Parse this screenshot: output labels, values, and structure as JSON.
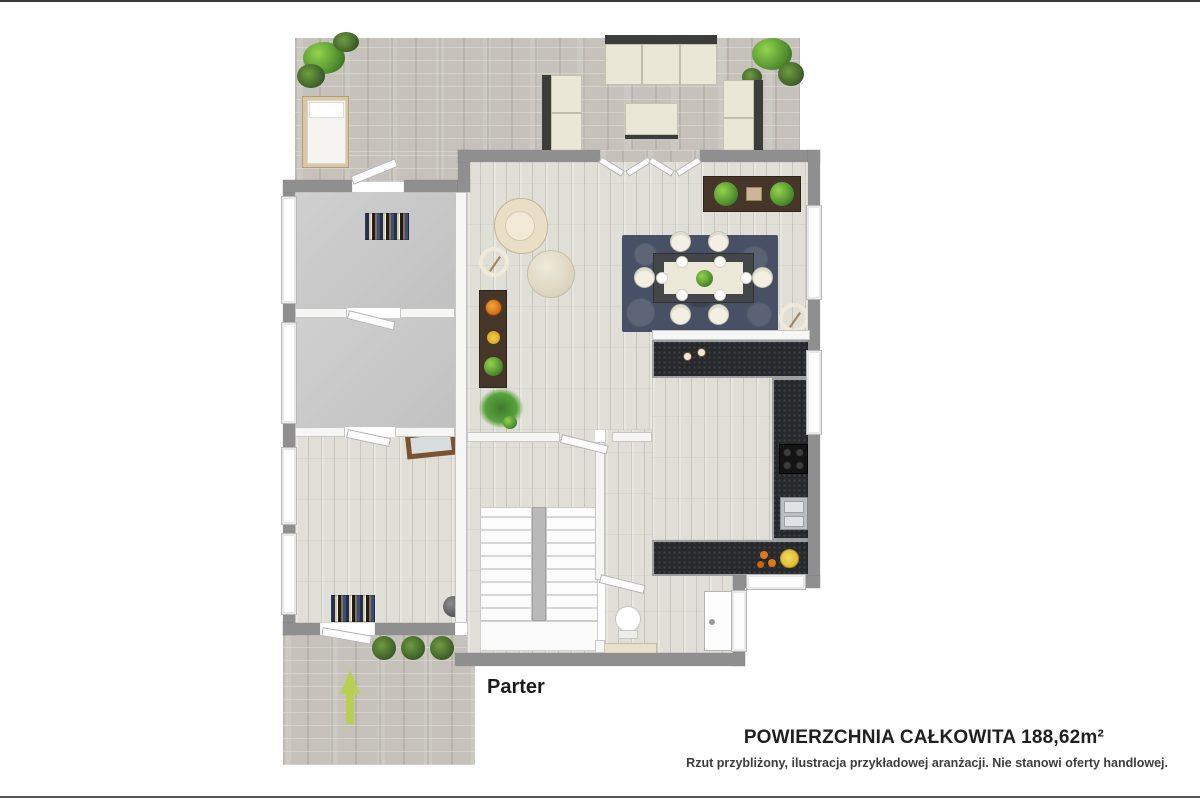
{
  "labels": {
    "floor_label": "Parter",
    "area_title": "POWIERZCHNIA CAŁKOWITA 188,62m²",
    "disclaimer": "Rzut przybliżony, ilustracja przykładowej aranżacji. Nie stanowi oferty handlowej."
  },
  "colors": {
    "paver": "#c6c2bb",
    "wood_floor": "#e0dfd7",
    "empty_room_floor": "#c9c9c9",
    "kitchen_counter": "#26282c",
    "exterior_wall": "#8f8f8f",
    "interior_wall": "#f6f6f5",
    "dining_rug": "#475064",
    "furniture_cream": "#ebe7d6",
    "wood_furniture": "#46362a",
    "plant_green": "#58a23c",
    "entrance_arrow_green": "#b8cf52",
    "plate_yellow": "#e8c93e",
    "fruit_orange": "#e07818"
  },
  "features": [
    "terrace-with-outdoor-lounge",
    "living-dining-room",
    "u-shaped-kitchen",
    "two-empty-rooms",
    "garden-room",
    "u-staircase",
    "wc-with-toilet",
    "front-door",
    "entrance-path-with-arrow",
    "french-patio-doors"
  ]
}
